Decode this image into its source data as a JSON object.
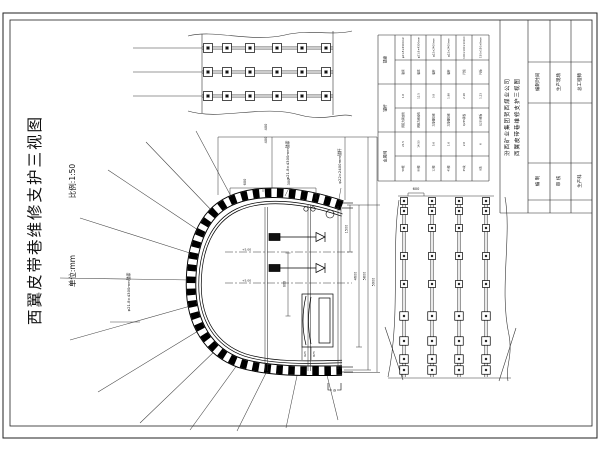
{
  "sheet": {
    "title": "西翼皮带巷维修支护三视图",
    "scale_label": "比例:1:50",
    "unit_label": "单位:mm"
  },
  "cross_section": {
    "anchor_cable_label_left": "φ21.8×4300mm锚索",
    "anchor_cable_label_top": "φ21.8×4300mm锚索",
    "anchor_bolt_label": "φ22×2400mm锚杆",
    "dim_top_chain": [
      "400",
      "400"
    ],
    "dim_arch_spacing": [
      "600",
      "300"
    ],
    "dim_right_chain": [
      "1500",
      "4600",
      "5800",
      "5900"
    ],
    "dim_bolt_spacing": "800",
    "dim_stand": [
      "625",
      "875"
    ],
    "level_marks": [
      "+5.00",
      "+5.00"
    ],
    "section_mark": "a"
  },
  "plan_view": {
    "rows": 3,
    "bolts_per_row": 6
  },
  "elevation_view": {
    "columns": 4,
    "bolts_per_column": 9,
    "dim_spacing": "600"
  },
  "material_table": {
    "side_headers": [
      "锚索",
      "锚杆",
      "金属网"
    ],
    "cells": [
      [
        "φ21.8×4300mm",
        "φ21.8×4300mm",
        "φ22×2400mm",
        "φ22×2400mm",
        "100×100×10mm",
        "150×150×8mm"
      ],
      [
        "锚索",
        "锚索",
        "锚杆",
        "锚杆",
        "托板",
        "托板"
      ],
      [
        "1.6",
        "12.5",
        "0.8",
        "1.98",
        "2.16",
        "1.23"
      ],
      [
        "预应力钢绞线",
        "预应力钢绞线",
        "左旋螺纹钢",
        "左旋螺纹钢",
        "Q235钢板",
        "Q235钢板"
      ],
      [
        "21.5",
        "14.50",
        "5.6",
        "1.6",
        "2.6",
        "6"
      ],
      [
        "56根",
        "88根",
        "12根",
        "45根",
        "35块",
        "8块"
      ]
    ]
  },
  "title_block": {
    "company": "汾西矿业集团贺西煤业公司",
    "drawing_title": "西翼皮带巷维修支护三视图",
    "fields_top": [
      "编制时间",
      "生产现场",
      "总工程师"
    ],
    "fields_bottom": [
      "编 制",
      "审 核",
      "生产科"
    ]
  }
}
